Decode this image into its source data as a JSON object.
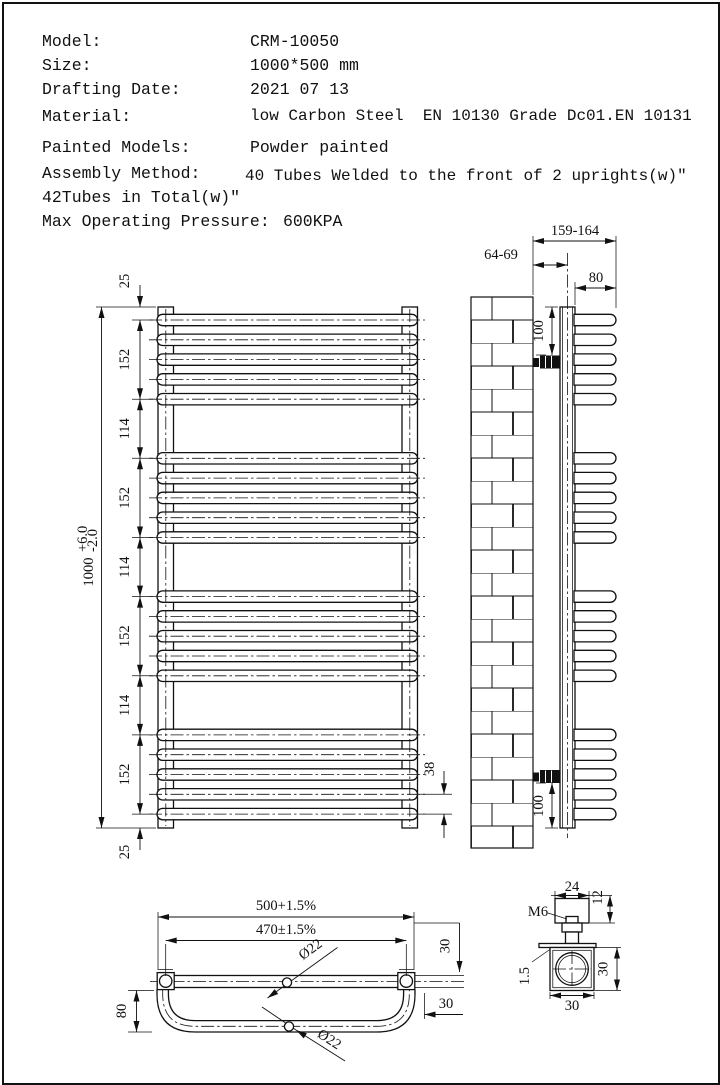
{
  "specs": {
    "rows": [
      {
        "label": "Model:",
        "value": "CRM-10050"
      },
      {
        "label": "Size:",
        "value": "1000*500 mm"
      },
      {
        "label": "Drafting Date:",
        "value": "2021 07 13"
      },
      {
        "label": "Material:",
        "value": "low Carbon Steel  EN 10130 Grade Dc01.EN 10131"
      },
      {
        "label": "Painted Models:",
        "value": "Powder painted"
      },
      {
        "label": "Assembly Method:",
        "value": "40 Tubes Welded to the front of 2 uprights(w)″"
      }
    ],
    "assembly_note": "42Tubes in Total(w)″",
    "pressure_label": "Max Operating Pressure:",
    "pressure_value": "600KPA"
  },
  "front_view": {
    "dim_top_offset": "25",
    "seg1": "152",
    "seg2": "114",
    "seg3": "152",
    "seg4": "114",
    "seg5": "152",
    "seg6": "114",
    "seg7": "152",
    "dim_bottom_offset": "25",
    "overall": "1000",
    "tol_plus": "+6.0",
    "tol_minus": "-2.0",
    "tube_pitch": "38"
  },
  "side_view": {
    "overall_depth": "159-164",
    "wall_to_center": "64-69",
    "tube_depth": "80",
    "bracket_top": "100",
    "bracket_bottom": "100"
  },
  "bottom_view": {
    "width": "500+1.5%",
    "centers": "470±1.5%",
    "dia_top": "Ø22",
    "dia_bottom": "Ø22",
    "depth": "80",
    "v_offset": "30",
    "h_offset": "30"
  },
  "detail_view": {
    "width": "24",
    "cap_height": "12",
    "thread": "M6",
    "wall_thickness": "1.5",
    "height": "30",
    "width_bottom": "30"
  }
}
